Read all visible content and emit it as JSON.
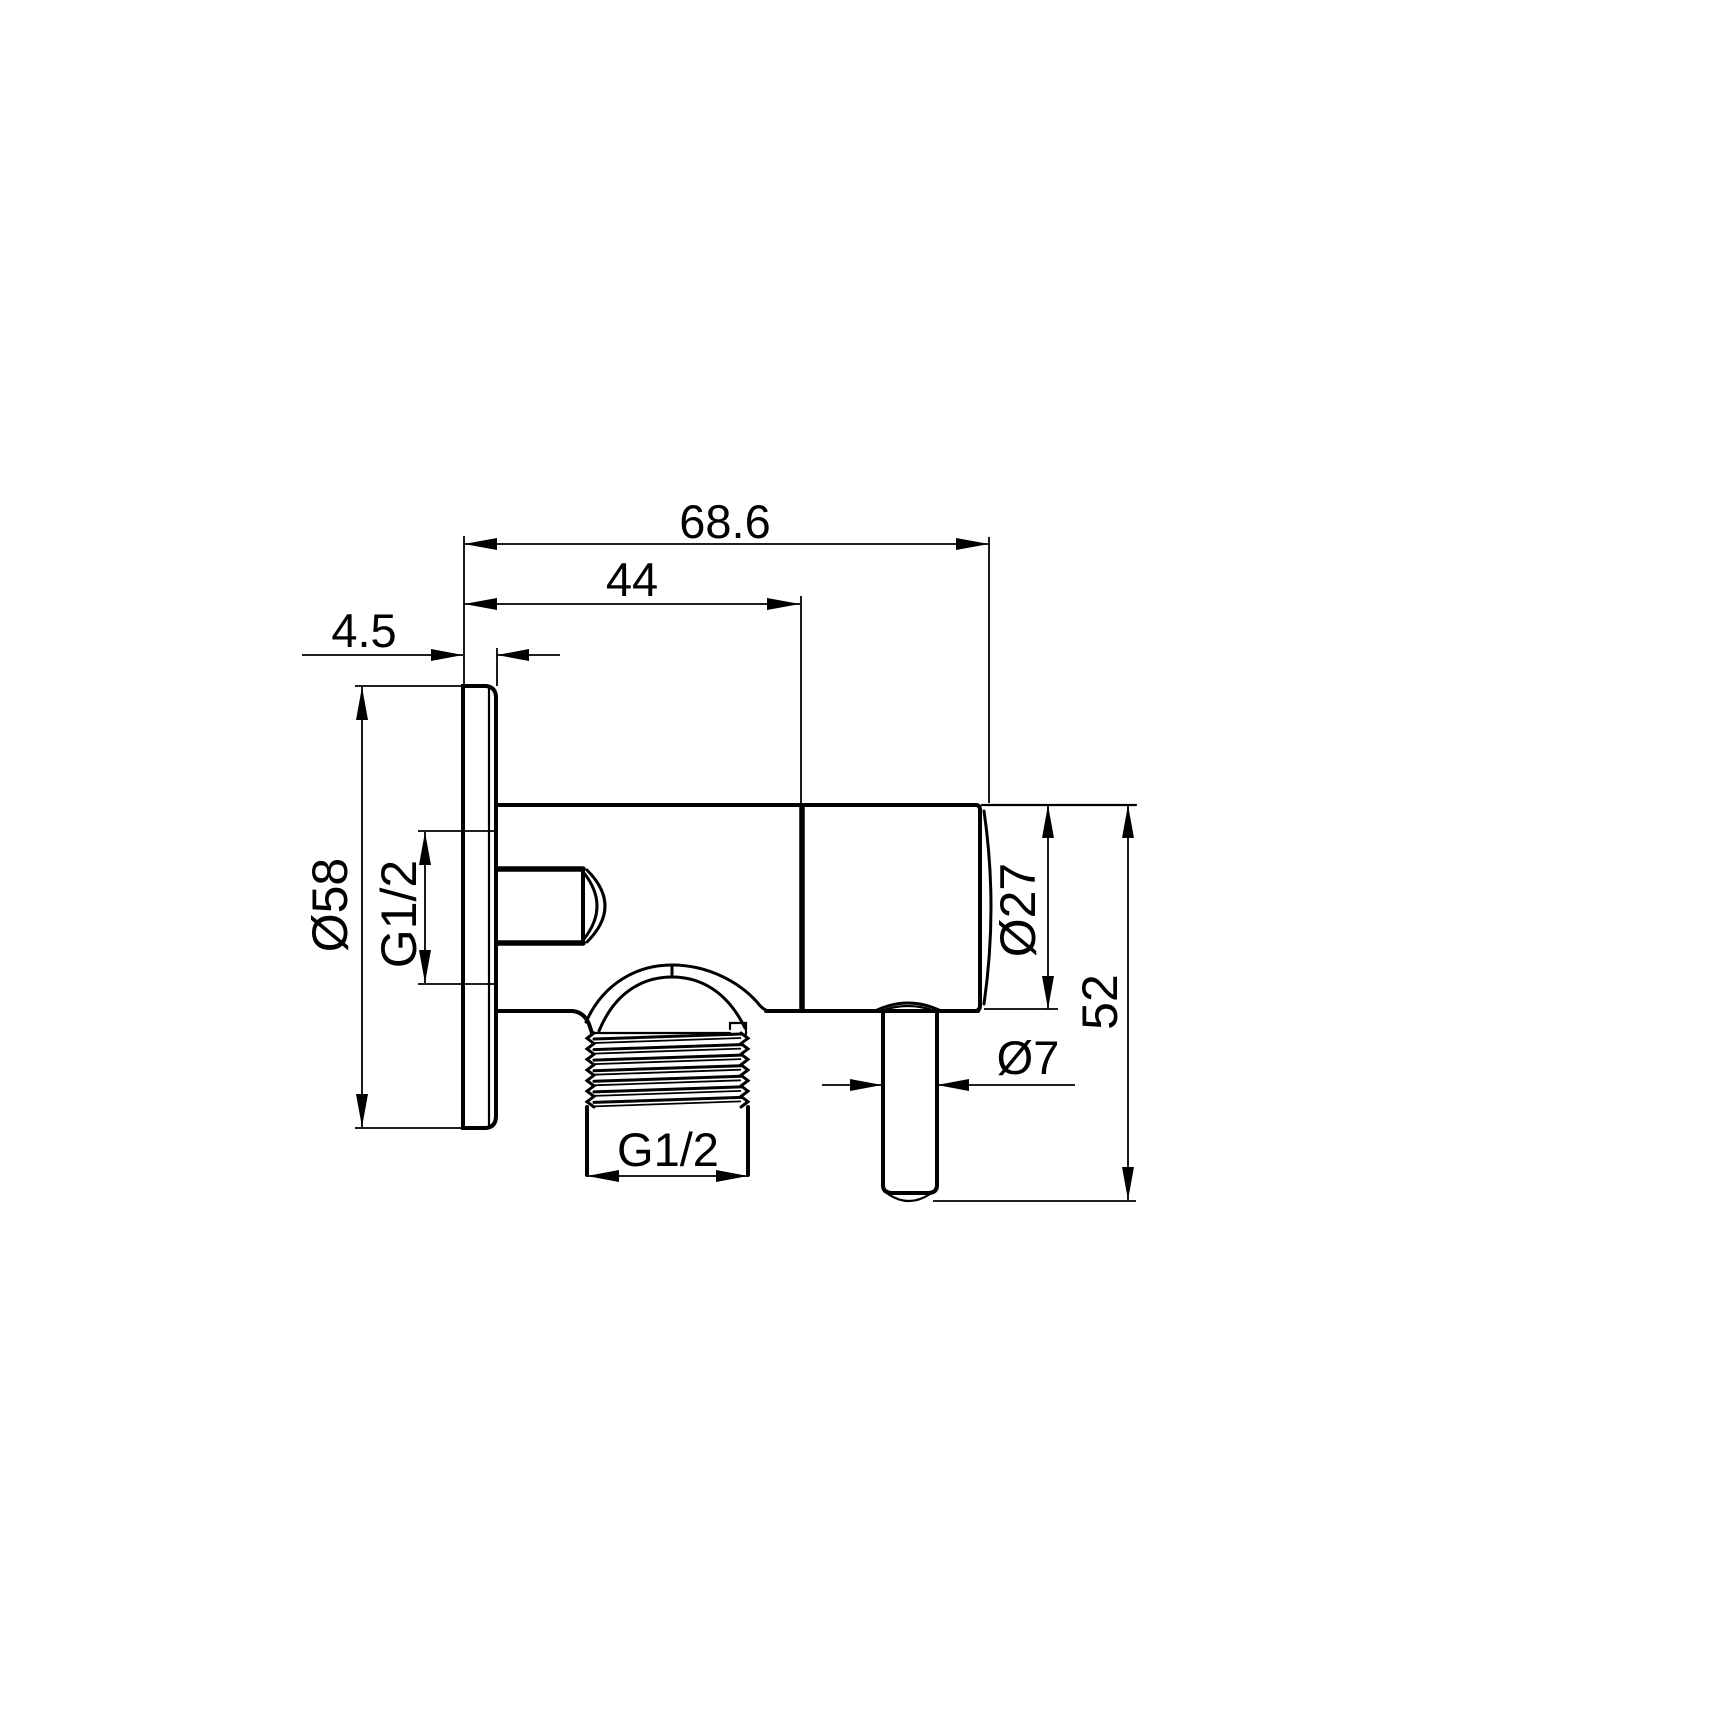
{
  "page": {
    "background": "#ffffff",
    "ink": "#000000"
  },
  "drawing": {
    "kind": "angle-valve-side-view-technical-drawing",
    "labels": {
      "overall_width": "68.6",
      "body_width": "44",
      "plate_thickness": "4.5",
      "plate_diameter": "Ø58",
      "inlet_thread": "G1/2",
      "knob_diameter": "Ø27",
      "overall_height": "52",
      "pin_diameter": "Ø7",
      "outlet_thread": "G1/2"
    }
  }
}
